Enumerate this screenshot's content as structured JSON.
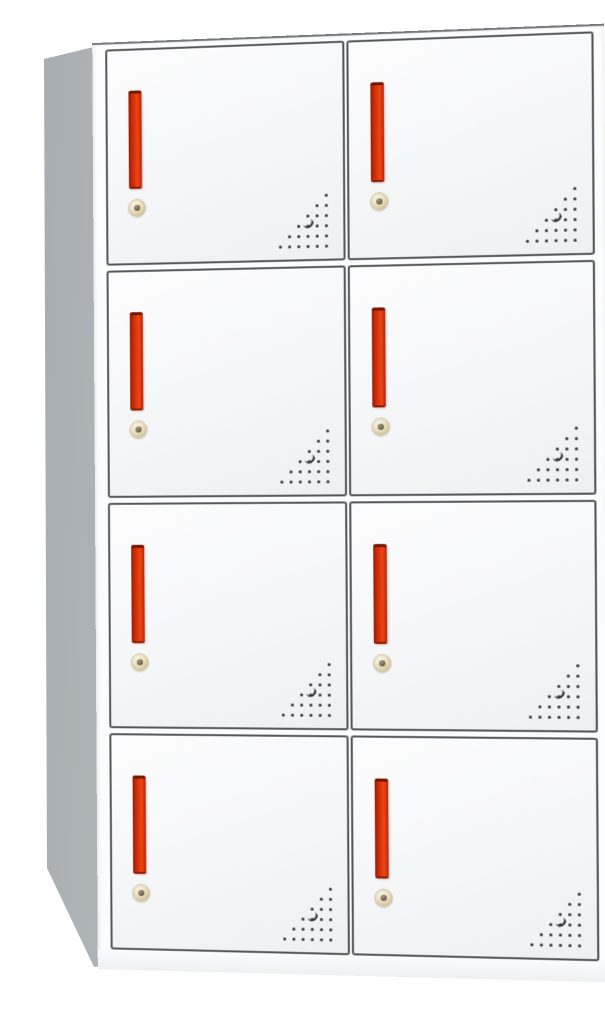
{
  "meta": {
    "description": "Product photo: front three-quarter view of a white steel locker cabinet with eight compartment doors arranged in 4 rows and 2 columns. Each door has a vertical recessed red pull handle, a round brass keyed cam lock below the handle, and a triangular grid of ventilation perforations in its lower-right corner. The cabinet's gray left side panel and white top edge are visible against a plain white background."
  },
  "cabinet": {
    "rows": 4,
    "columns": 2,
    "door_count": 8,
    "doors": [
      {
        "id": "door-r1-c1",
        "row": 1,
        "col": 1
      },
      {
        "id": "door-r1-c2",
        "row": 1,
        "col": 2
      },
      {
        "id": "door-r2-c1",
        "row": 2,
        "col": 1
      },
      {
        "id": "door-r2-c2",
        "row": 2,
        "col": 2
      },
      {
        "id": "door-r3-c1",
        "row": 3,
        "col": 1
      },
      {
        "id": "door-r3-c2",
        "row": 3,
        "col": 2
      },
      {
        "id": "door-r4-c1",
        "row": 4,
        "col": 1
      },
      {
        "id": "door-r4-c2",
        "row": 4,
        "col": 2
      }
    ],
    "door_features": {
      "handle": "vertical recessed pull handle, red-orange",
      "lock": "round keyed cam lock, brass with dark keyhole",
      "vents": "right-angled triangular perforation pattern with one larger crescent-shaded hole"
    },
    "vents": {
      "dot_rows": 6,
      "small_holes_per_door": 21,
      "large_holes_per_door": 1
    },
    "colors": {
      "background": "#ffffff",
      "front_frame": "#fbfcfd",
      "door_face_light": "#fdfdfe",
      "door_face_shade": "#eef0f2",
      "door_border": "#54585c",
      "side_panel_dark": "#a5aaae",
      "side_panel_mid": "#b7bcbf",
      "side_panel_light": "#c6cacd",
      "top_edge_white": "#f7f9fa",
      "handle_red_bright": "#ee4614",
      "handle_red_mid": "#dd350d",
      "handle_red_dark": "#8f1d05",
      "lock_brass_light": "#f7f0dd",
      "lock_brass_mid": "#d9caa3",
      "lock_brass_dark": "#b3a478",
      "keyhole": "#5a5243",
      "vent_hole": "#34373a"
    }
  }
}
